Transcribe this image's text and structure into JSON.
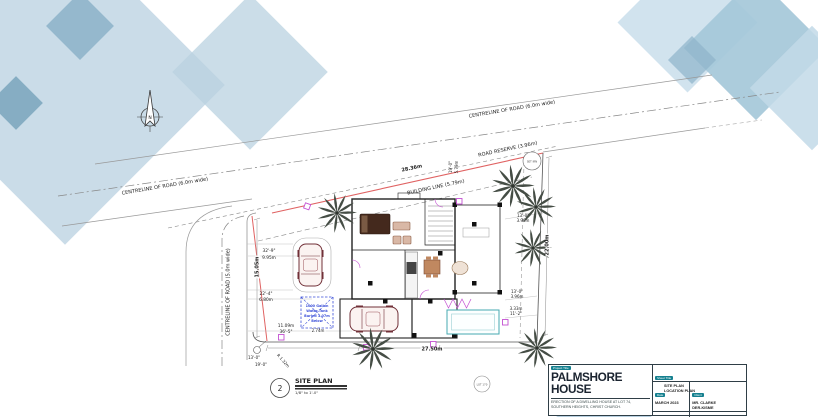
{
  "north": {
    "letter": "N"
  },
  "roads": {
    "centreline_top": "CENTRELINE OF ROAD (6.0m wide)",
    "centreline_top_right": "CENTRELINE OF ROAD (6.0m wide)",
    "centreline_left": "CENTRELINE OF ROAD (5.0m wide)",
    "road_reserve": "ROAD RESERVE (3.96m)",
    "building_line": "BUILDING LINE (5.79m)"
  },
  "dims": {
    "frontage": "28.36m",
    "west": "15.05m",
    "east": "22.00m",
    "south": "27.50m",
    "ft_32_9": "32'-9\"",
    "m_9_95": "9.95m",
    "ft_22_4": "22'-4\"",
    "m_6_80": "6.80m",
    "m_11_09": "11.09m",
    "ft_36_5": "36'-5\"",
    "ft_13_0_a": "13'-0\"",
    "m_3_96_a": "3.96m",
    "ft_13_0_b": "13'-0\"",
    "m_3_96_b": "3.96m",
    "m_3_33": "3.33m",
    "ft_11_2": "11'-2\"",
    "m_2_74": "2.74m",
    "ft_19_0": "19'-0\"",
    "m_5_79": "5.79m",
    "corner_radius": "R 1.32m",
    "offset_13": "13'-0\"",
    "offset_19": "19'-0\""
  },
  "tank": {
    "line1": "1000 Gallon",
    "line2": "Water Tank",
    "line3": "Buried 1.07m",
    "line4": "Below"
  },
  "markers": {
    "pin": "SET IRN",
    "lot": "LOT 170"
  },
  "site_label": {
    "number": "2",
    "title": "SITE PLAN",
    "scale": "1/8\" to 1'-0\""
  },
  "title_block": {
    "project_label": "Project Title",
    "project": "PALMSHORE HOUSE",
    "description": "ERECTION OF A DWELLING HOUSE AT LOT 74, SOUTHERN HEIGHTS, CHRIST CHURCH.",
    "sheet_label": "Sheet Title",
    "sheet_line1": "SITE PLAN",
    "sheet_line2": "LOCATION PLAN",
    "date_label": "Date",
    "date": "MARCH 2023",
    "client_label": "Client",
    "client_line1": "MR. CLARKE",
    "client_line2": "DER-KISME",
    "scale_label": "Scale",
    "scale": "AS SHOWN",
    "drawn_label": "Drawn By",
    "drawn": "ROMFORD THOMSON"
  },
  "colors": {
    "accent_teal": "#15808f",
    "boundary_red": "#e06262",
    "tank_blue": "#3b4fd8",
    "magenta": "#c44fd2",
    "pool_teal": "#46aab2",
    "deco_blue": "#a3c6d8"
  }
}
